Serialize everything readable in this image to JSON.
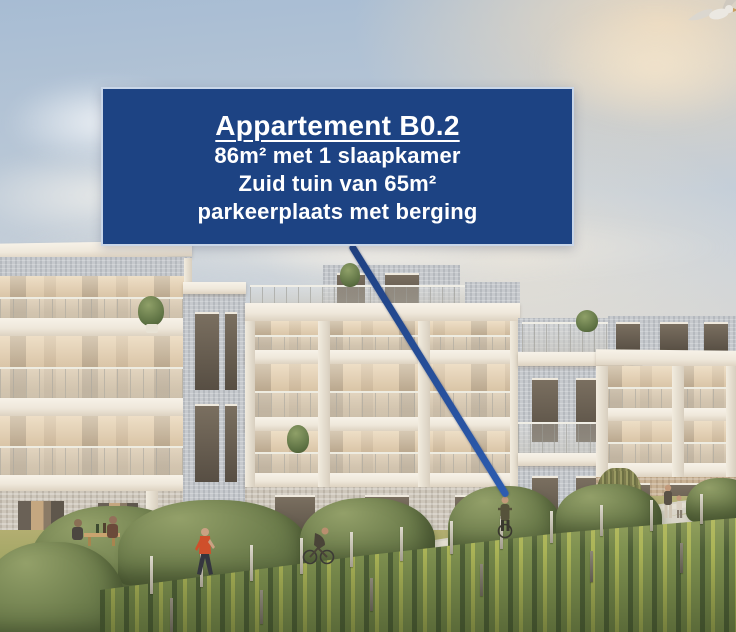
{
  "overlay_card": {
    "title": "Appartement B0.2",
    "details": [
      "86m² met 1 slaapkamer",
      "Zuid tuin van 65m²",
      "parkeerplaats met berging"
    ]
  },
  "palette": {
    "card_bg": "#1d4383",
    "card_border": "#c9d6e8",
    "card_text": "#ffffff",
    "pointer_line": "#2a58ab",
    "sky_top": "#a7bcd3",
    "sky_horizon": "#f1e5cf",
    "facade_white": "#f3eee4",
    "facade_brick_grey": "#c6c9cd",
    "balcony_warm": "#d9c2a0",
    "hedge_green": "#6d7d4c",
    "grass_green": "#9aa35f",
    "vineyard_green": "#7f9150",
    "path_grey": "#d9d5c9"
  }
}
